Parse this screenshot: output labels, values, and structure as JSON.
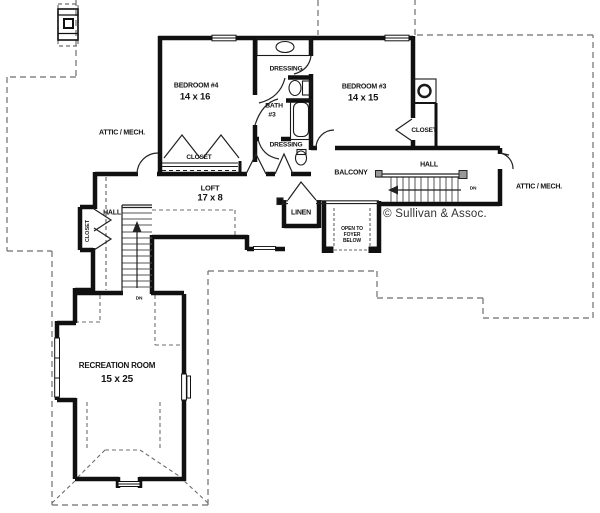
{
  "plan": {
    "copyright": "© Sullivan & Assoc.",
    "rooms": {
      "bedroom4": {
        "name": "BEDROOM #4",
        "dims": "14 x 16"
      },
      "bedroom3": {
        "name": "BEDROOM #3",
        "dims": "14 x 15"
      },
      "bath3": {
        "name": "BATH",
        "number": "#3"
      },
      "loft": {
        "name": "LOFT",
        "dims": "17 x 8"
      },
      "recreation": {
        "name": "RECREATION ROOM",
        "dims": "15 x 25"
      },
      "balcony": "BALCONY",
      "linen": "LINEN",
      "dressing_upper": "DRESSING",
      "dressing_lower": "DRESSING",
      "closet_bedroom4": "CLOSET",
      "closet_bedroom3": "CLOSET",
      "closet_hall": "CLOSET",
      "hall_left": "HALL",
      "hall_right": "HALL",
      "attic_left": "ATTIC / MECH.",
      "attic_right": "ATTIC / MECH.",
      "open_foyer": {
        "line1": "OPEN TO",
        "line2": "FOYER",
        "line3": "BELOW"
      }
    },
    "stairs": {
      "down_left": "DN",
      "down_right": "DN"
    }
  }
}
